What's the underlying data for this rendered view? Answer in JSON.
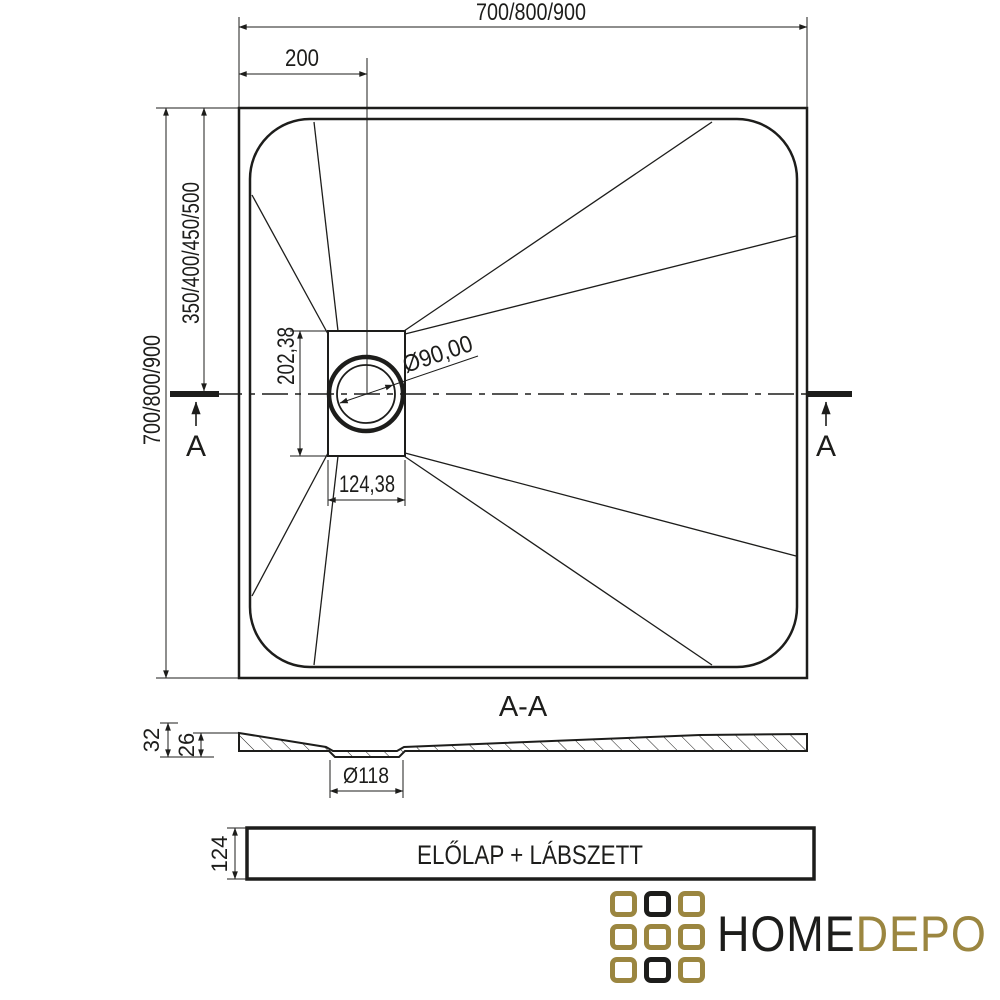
{
  "drawing": {
    "top_view": {
      "dim_width_top": "700/800/900",
      "dim_offset_drain": "200",
      "dim_height_left": "700/800/900",
      "dim_center_left": "350/400/450/500",
      "dim_drain_recess_height": "202,38",
      "dim_drain_recess_width": "124,38",
      "dim_drain_diameter": "Ø90,00",
      "section_marker_left": "A",
      "section_marker_right": "A"
    },
    "section_view": {
      "title": "A-A",
      "dim_total_height": "32",
      "dim_floor_height": "26",
      "dim_recess_diameter": "Ø118"
    },
    "front_panel": {
      "label": "ELŐLAP + LÁBSZETT",
      "dim_height": "124"
    }
  },
  "logo": {
    "text_primary": "HOME",
    "text_secondary": "DEPO",
    "color_gold": "#9b8640",
    "color_black": "#1d1d1b",
    "grid": [
      [
        "gold",
        "black",
        "gold"
      ],
      [
        "gold",
        "gold",
        "gold"
      ],
      [
        "gold",
        "black",
        "gold"
      ]
    ]
  },
  "colors": {
    "line": "#1d1d1b",
    "background": "#ffffff"
  }
}
